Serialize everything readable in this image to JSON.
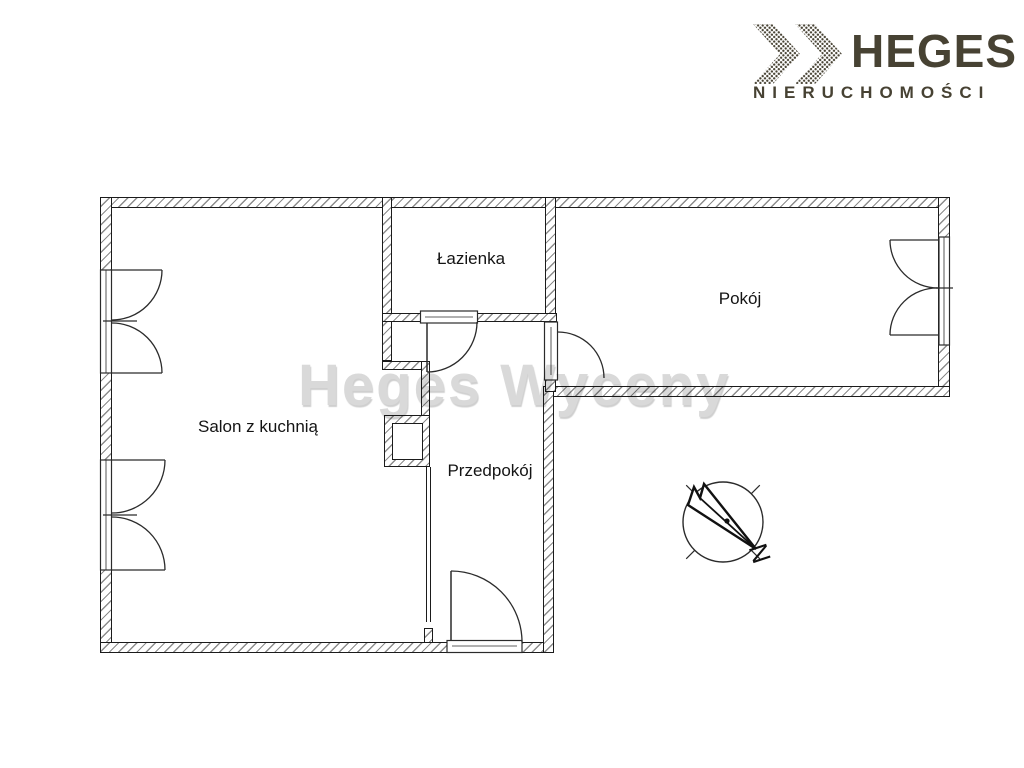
{
  "brand": {
    "name": "HEGES",
    "tagline": "NIERUCHOMOŚCI",
    "color": "#474233",
    "chevrons_icon": "dotted-double-chevron-right"
  },
  "watermark": {
    "text": "Heges Wyceny"
  },
  "plan": {
    "rooms": [
      {
        "label": "Salon z kuchnią"
      },
      {
        "label": "Łazienka"
      },
      {
        "label": "Przedpokój"
      },
      {
        "label": "Pokój"
      }
    ],
    "compass": {
      "north_label": "N"
    }
  }
}
